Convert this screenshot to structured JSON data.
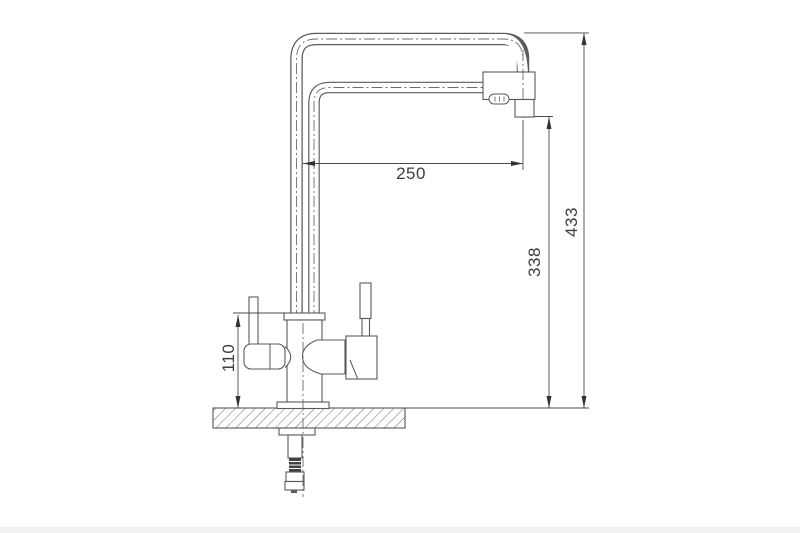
{
  "meta": {
    "type": "technical-drawing",
    "subject": "kitchen faucet side view with mounting shank",
    "units": "mm"
  },
  "dimensions": {
    "spout_reach": "250",
    "overall_height": "433",
    "spout_outlet_height": "338",
    "handle_height": "110"
  },
  "colors": {
    "background": "#ffffff",
    "line": "#595959",
    "dimension_line": "#4a4a4a",
    "dimension_text": "#3d3d3d",
    "thread_fill": "#414141"
  },
  "components": [
    "tall-spout-tube",
    "filtered-water-tube",
    "spout-head",
    "aerator-outlet",
    "faucet-body",
    "left-lever-handle",
    "right-lever-handle",
    "countertop-section",
    "threaded-shank-with-nuts"
  ]
}
